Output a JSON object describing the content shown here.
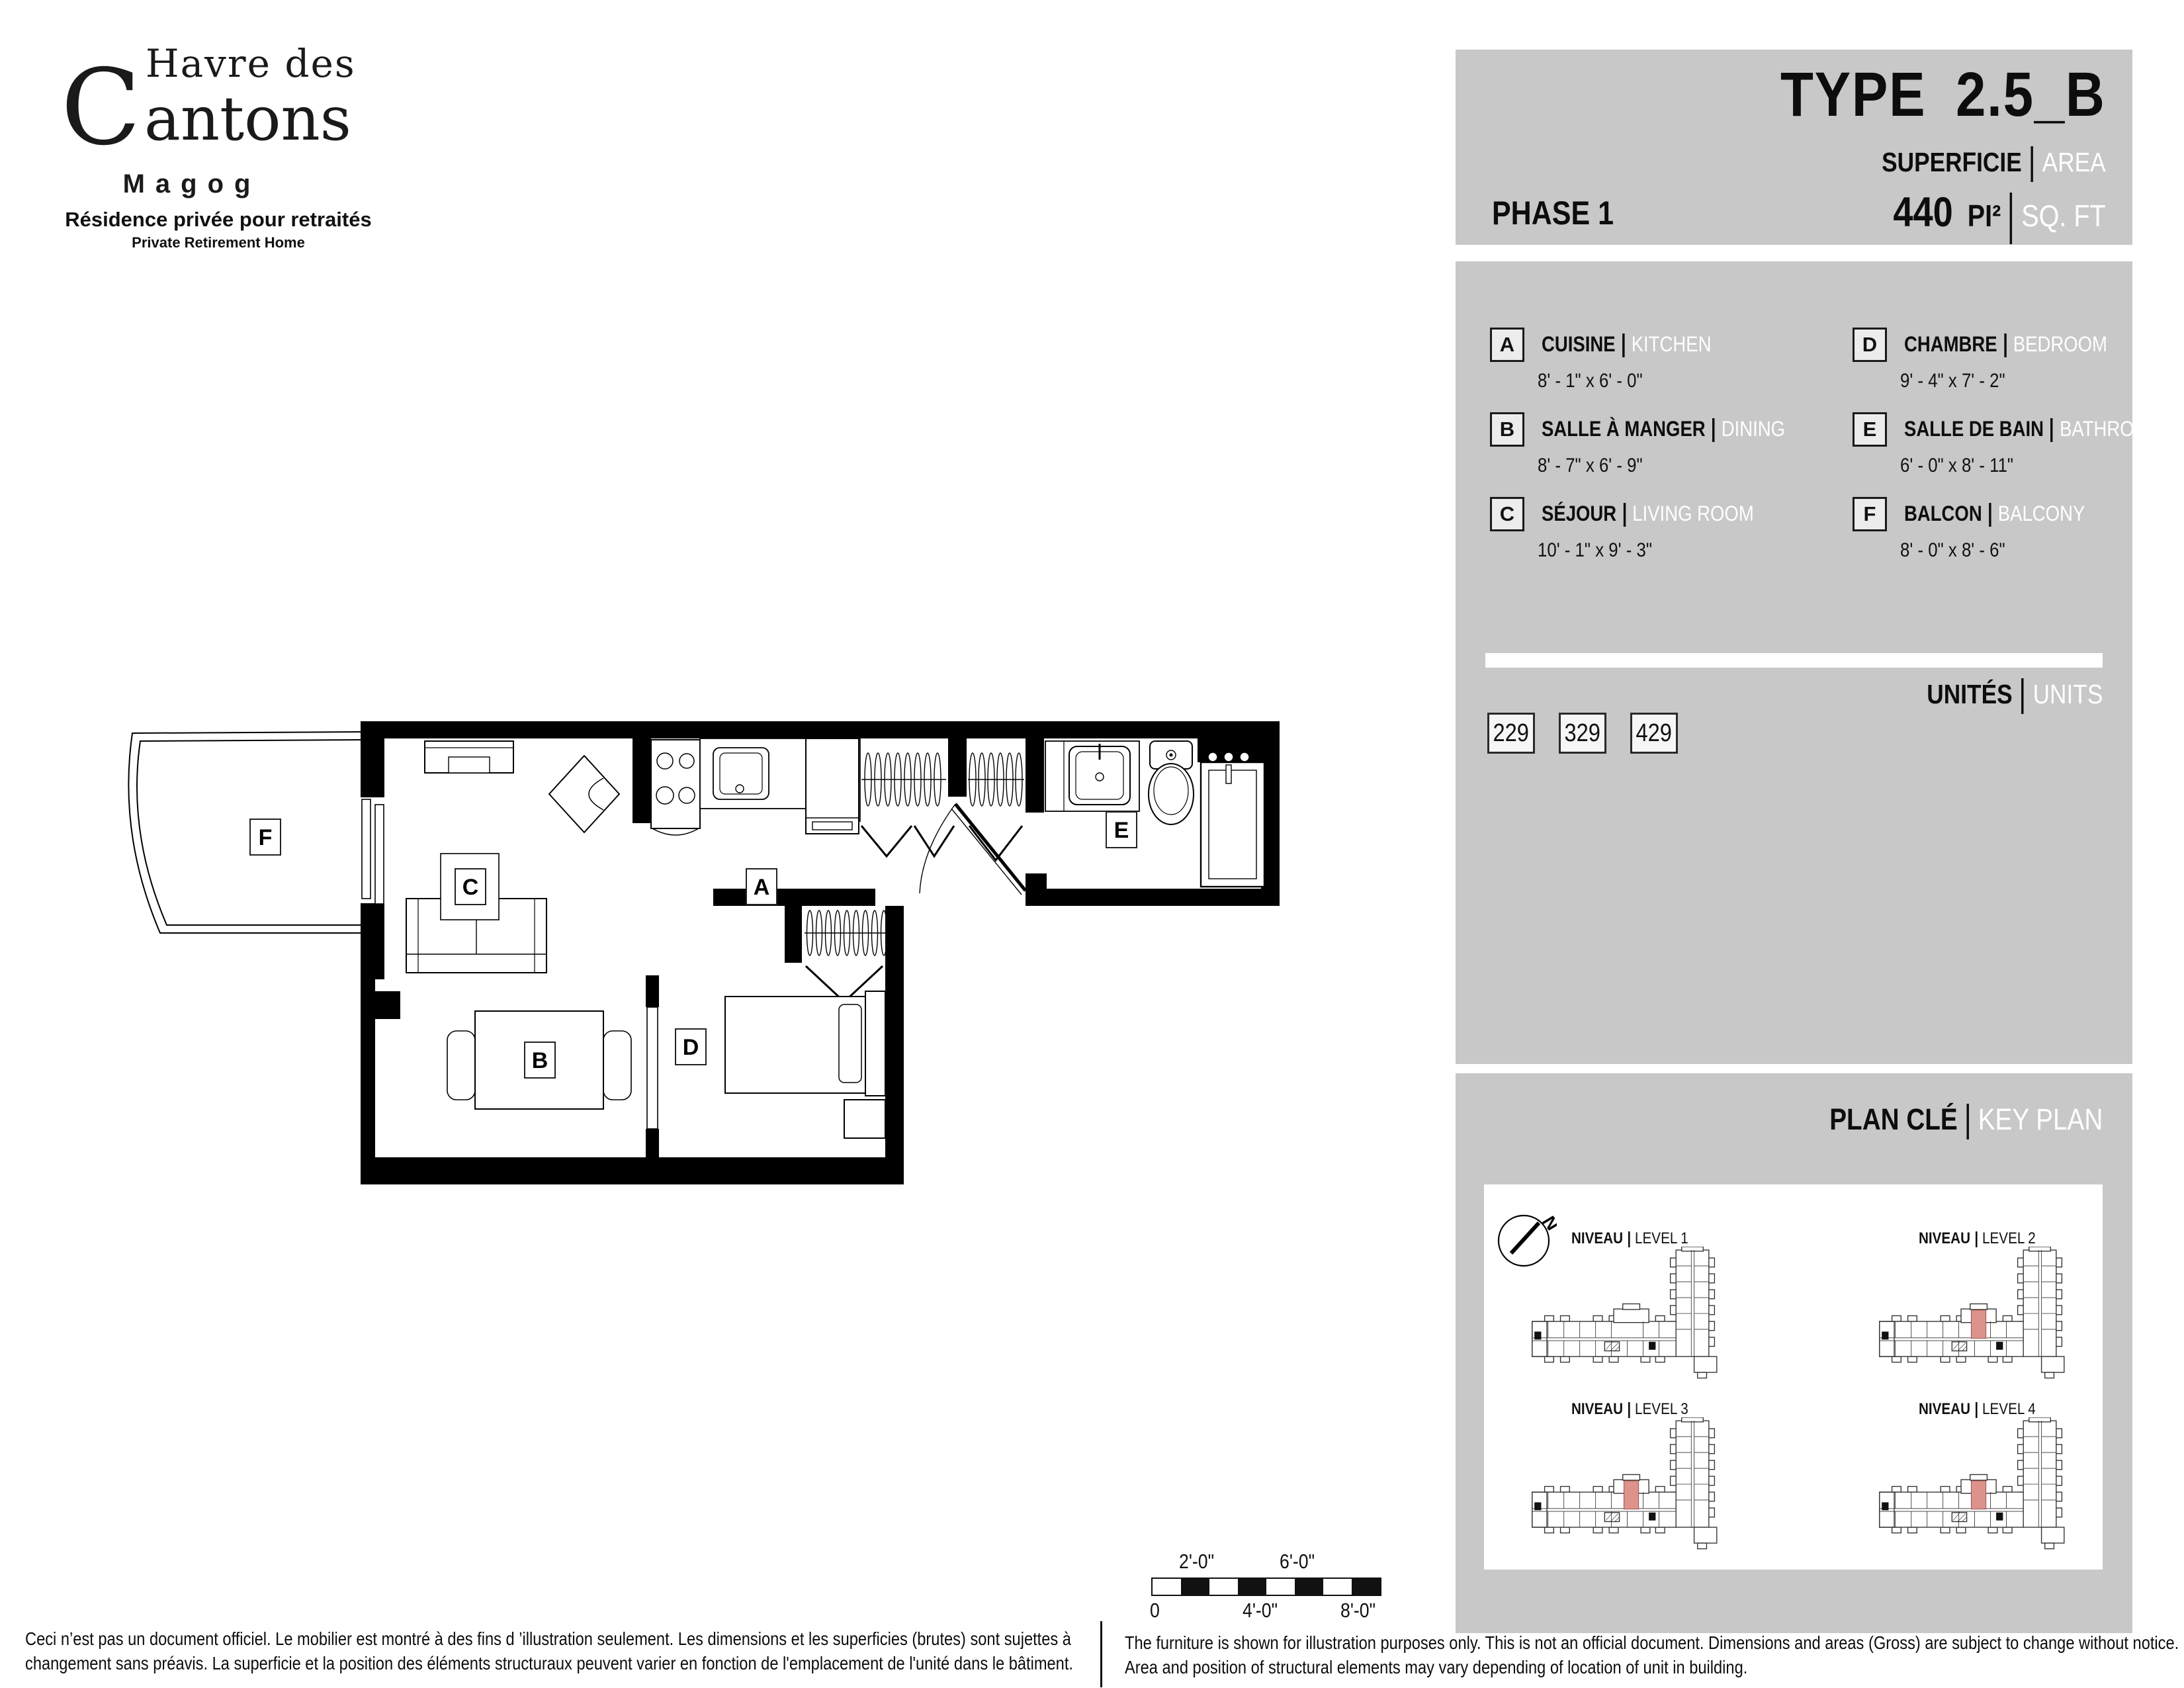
{
  "logo": {
    "top": "Havre des",
    "initial": "C",
    "rest": "antons",
    "city": "Magog",
    "tagline_fr": "Résidence privée pour retraités",
    "tagline_en": "Private Retirement Home"
  },
  "header": {
    "phase": "PHASE 1",
    "type_prefix": "TYPE",
    "type_code": "2.5_B",
    "area_label_fr": "SUPERFICIE",
    "area_label_en": "AREA",
    "area_value": "440",
    "area_unit_fr": "PI²",
    "area_unit_en": "SQ. FT"
  },
  "legend": {
    "items": [
      {
        "code": "A",
        "name_fr": "CUISINE",
        "name_en": "KITCHEN",
        "dims": "8' - 1\" x 6' - 0\""
      },
      {
        "code": "B",
        "name_fr": "SALLE À MANGER",
        "name_en": "DINING",
        "dims": "8' - 7\" x 6' - 9\""
      },
      {
        "code": "C",
        "name_fr": "SÉJOUR",
        "name_en": "LIVING ROOM",
        "dims": "10' - 1\" x 9' - 3\""
      },
      {
        "code": "D",
        "name_fr": "CHAMBRE",
        "name_en": "BEDROOM",
        "dims": "9' - 4\" x 7' - 2\""
      },
      {
        "code": "E",
        "name_fr": "SALLE DE BAIN",
        "name_en": "BATHROOM",
        "dims": "6' - 0\" x 8' - 11\""
      },
      {
        "code": "F",
        "name_fr": "BALCON",
        "name_en": "BALCONY",
        "dims": "8' - 0\" x 8' - 6\""
      }
    ]
  },
  "units": {
    "label_fr": "UNITÉS",
    "label_en": "UNITS",
    "numbers": [
      "229",
      "329",
      "429"
    ]
  },
  "keyplan": {
    "title_fr": "PLAN CLÉ",
    "title_en": "KEY PLAN",
    "niveau_label": "NIVEAU",
    "levels": [
      {
        "label": "LEVEL 1",
        "highlighted": false
      },
      {
        "label": "LEVEL 2",
        "highlighted": true
      },
      {
        "label": "LEVEL 3",
        "highlighted": true
      },
      {
        "label": "LEVEL 4",
        "highlighted": true
      }
    ],
    "north_letter": "N"
  },
  "floorplan": {
    "rooms": {
      "a": "A",
      "b": "B",
      "c": "C",
      "d": "D",
      "e": "E",
      "f": "F"
    }
  },
  "scalebar": {
    "above": [
      "2'-0\"",
      "6'-0\""
    ],
    "below": [
      "0",
      "4'-0\"",
      "8'-0\""
    ]
  },
  "footer": {
    "fr_line1": "Ceci n’est pas un document officiel.  Le mobilier est montré à des fins d ’illustration seulement.  Les dimensions et les superficies (brutes) sont sujettes à",
    "fr_line2": "changement sans préavis. La superficie et la position des éléments structuraux peuvent varier en fonction de l'emplacement de l'unité dans le bâtiment.",
    "en_line1": "The furniture is shown for illustration purposes only.  This is not an official document.  Dimensions and areas (Gross) are subject to change without notice.",
    "en_line2": "Area and position of structural elements may vary depending of location of unit in building."
  },
  "colors": {
    "panel_gray": "#c8c8c8",
    "highlight": "#dd928b",
    "ink": "#0d0d0d"
  }
}
